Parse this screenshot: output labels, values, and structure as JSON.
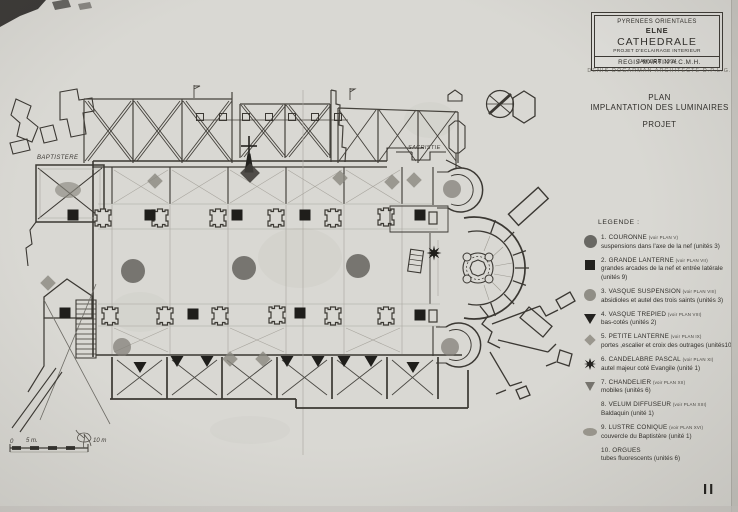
{
  "title_block": {
    "region": "PYRENEES ORIENTALES",
    "city": "ELNE",
    "building": "CATHEDRALE",
    "project": "PROJET D'ECLAIRAGE INTERIEUR",
    "date": "JANVIER 1994"
  },
  "credits": {
    "line1": "REGIS MARTIN  A.C.M.H.",
    "line2": "DENIS DOGARMAN  ARCHITECTE  D.P.L.G."
  },
  "heading": {
    "line1": "PLAN",
    "line2": "IMPLANTATION DES LUMINAIRES",
    "line3": "PROJET"
  },
  "legend": {
    "title": "LEGENDE :",
    "items": [
      {
        "name": "1. COURONNE",
        "ref": "(voir PLAN V)",
        "desc": "suspensions dans l'axe de la nef  (unités 3)",
        "icon": "dark-circle"
      },
      {
        "name": "2. GRANDE LANTERNE",
        "ref": "(voir PLAN VII)",
        "desc": "grandes arcades de la nef et entrée latérale (unités 9)",
        "icon": "black-square"
      },
      {
        "name": "3. VASQUE SUSPENSION",
        "ref": "(voir PLAN VIII)",
        "desc": "absidioles et autel des trois saints (unités  3)",
        "icon": "grey-circle"
      },
      {
        "name": "4. VASQUE TREPIED",
        "ref": "(voir PLAN VIII)",
        "desc": "bas-cotés (unités  2)",
        "icon": "black-triangle"
      },
      {
        "name": "5. PETITE LANTERNE",
        "ref": "(voir PLAN IX)",
        "desc": "portes ,escalier et croix des outrages (unités10)",
        "icon": "grey-diamond"
      },
      {
        "name": "6. CANDELABRE PASCAL",
        "ref": "(voir PLAN XI)",
        "desc": "autel majeur coté Evangile (unité 1)",
        "icon": "black-star"
      },
      {
        "name": "7. CHANDELIER",
        "ref": "(voir PLAN XII)",
        "desc": "mobiles (unités  6)",
        "icon": "grey-triangle"
      },
      {
        "name": "8. VELUM DIFFUSEUR",
        "ref": "(voir PLAN XIII)",
        "desc": "Baldaquin (unité 1)",
        "icon": "none"
      },
      {
        "name": "9. LUSTRE CONIQUE",
        "ref": "(voir PLAN XVI)",
        "desc": "couvercle du Baptistère (unité 1)",
        "icon": "grey-ellipse"
      },
      {
        "name": "10. ORGUES",
        "ref": "",
        "desc": "tubes fluorescents (unités 6)",
        "icon": "none"
      }
    ]
  },
  "plan": {
    "labels": {
      "baptistere": "BAPTISTERE",
      "sacristie": "SACRISTIE"
    },
    "scale": {
      "zero": "0",
      "five": "5 m.",
      "ten": "10 m"
    },
    "markers": [
      {
        "type": "couronne",
        "x": 133,
        "y": 271
      },
      {
        "type": "couronne",
        "x": 244,
        "y": 268
      },
      {
        "type": "couronne",
        "x": 358,
        "y": 266
      },
      {
        "type": "vasque",
        "x": 452,
        "y": 189
      },
      {
        "type": "vasque",
        "x": 450,
        "y": 347
      },
      {
        "type": "vasque",
        "x": 122,
        "y": 347
      },
      {
        "type": "lustre",
        "x": 68,
        "y": 190
      },
      {
        "type": "grande",
        "x": 73,
        "y": 215
      },
      {
        "type": "grande",
        "x": 150,
        "y": 215
      },
      {
        "type": "grande",
        "x": 237,
        "y": 215
      },
      {
        "type": "grande",
        "x": 305,
        "y": 215
      },
      {
        "type": "grande",
        "x": 420,
        "y": 215
      },
      {
        "type": "grande",
        "x": 65,
        "y": 313
      },
      {
        "type": "grande",
        "x": 193,
        "y": 314
      },
      {
        "type": "grande",
        "x": 300,
        "y": 313
      },
      {
        "type": "grande",
        "x": 420,
        "y": 315
      },
      {
        "type": "petite",
        "x": 155,
        "y": 181
      },
      {
        "type": "petite",
        "x": 340,
        "y": 178
      },
      {
        "type": "petite",
        "x": 392,
        "y": 182
      },
      {
        "type": "petite",
        "x": 414,
        "y": 180
      },
      {
        "type": "petite",
        "x": 48,
        "y": 283
      },
      {
        "type": "petite",
        "x": 230,
        "y": 359
      },
      {
        "type": "petite",
        "x": 263,
        "y": 359
      },
      {
        "type": "petite-dark",
        "x": 250,
        "y": 173
      },
      {
        "type": "trepied",
        "x": 140,
        "y": 367
      },
      {
        "type": "trepied",
        "x": 177,
        "y": 361
      },
      {
        "type": "trepied",
        "x": 207,
        "y": 361
      },
      {
        "type": "trepied",
        "x": 287,
        "y": 361
      },
      {
        "type": "trepied",
        "x": 318,
        "y": 361
      },
      {
        "type": "trepied",
        "x": 344,
        "y": 361
      },
      {
        "type": "trepied",
        "x": 371,
        "y": 361
      },
      {
        "type": "trepied",
        "x": 413,
        "y": 367
      },
      {
        "type": "pascal",
        "x": 434,
        "y": 253
      },
      {
        "type": "organ",
        "x": 200,
        "y": 117
      },
      {
        "type": "organ",
        "x": 223,
        "y": 117
      },
      {
        "type": "organ",
        "x": 246,
        "y": 117
      },
      {
        "type": "organ",
        "x": 269,
        "y": 117
      },
      {
        "type": "organ",
        "x": 292,
        "y": 117
      },
      {
        "type": "organ",
        "x": 315,
        "y": 117
      },
      {
        "type": "organ",
        "x": 338,
        "y": 117
      }
    ]
  },
  "sheet_number": "II",
  "colors": {
    "paper": "#d9d8d3",
    "ink": "#3b3833",
    "pencil": "#a7a49c",
    "fill_dark": "#23221f",
    "fill_grey": "#8f8d85"
  }
}
